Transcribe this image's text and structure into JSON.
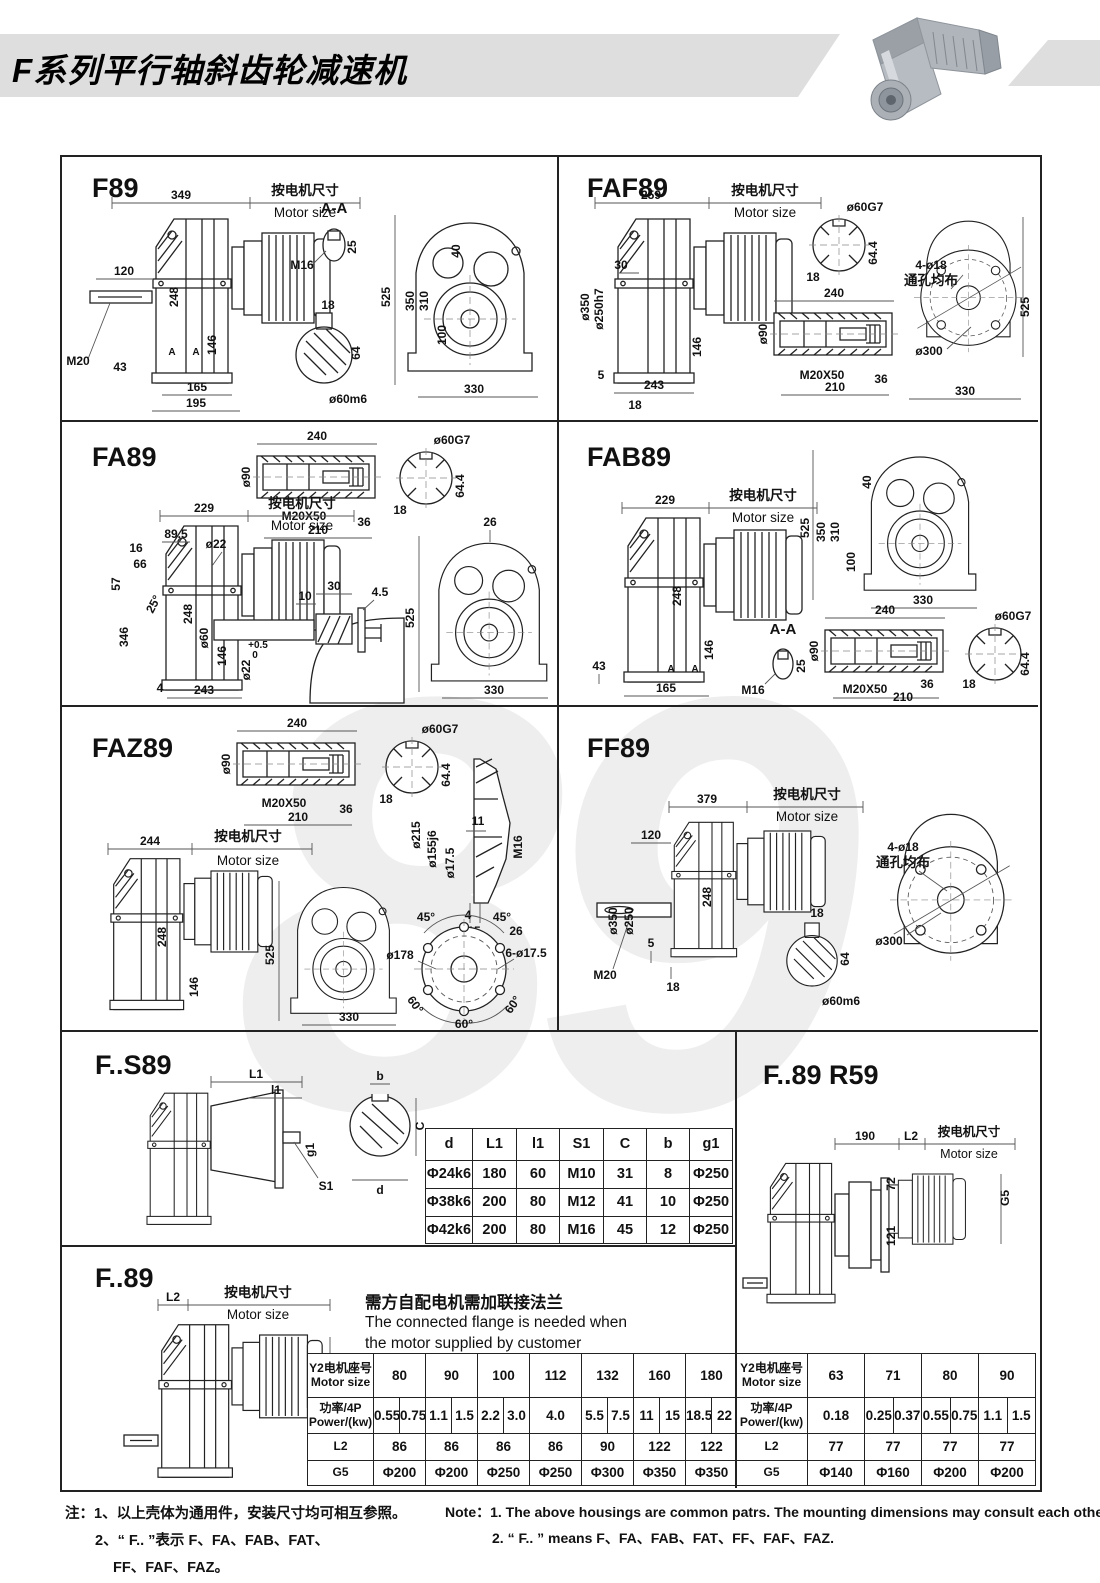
{
  "header": {
    "title": "F系列平行轴斜齿轮减速机"
  },
  "watermark": "89",
  "common": {
    "motor_zh": "按电机尺寸",
    "motor_en": "Motor size"
  },
  "panels": {
    "f89": {
      "title": "F89",
      "aa": "A-A",
      "d349": "349",
      "d120": "120",
      "d248": "248",
      "d146": "146",
      "m20": "M20",
      "d43": "43",
      "d165": "165",
      "d195": "195",
      "m16": "M16",
      "d25": "25",
      "d18": "18",
      "d64": "64",
      "d60m6": "ø60m6",
      "d525": "525",
      "d350": "350",
      "d310": "310",
      "d100": "100",
      "d40": "40",
      "d330": "330",
      "a": "A"
    },
    "faf89": {
      "title": "FAF89",
      "d259": "259",
      "d60g7": "ø60G7",
      "d18": "18",
      "d644": "64.4",
      "d350": "ø350",
      "d250h7": "ø250h7",
      "d30": "30",
      "d146": "146",
      "d5": "5",
      "d243": "243",
      "d18b": "18",
      "d240": "240",
      "d90": "ø90",
      "m20x50": "M20X50",
      "d36": "36",
      "d210": "210",
      "holes": "4-ø18",
      "holes2": "通孔均布",
      "d300": "ø300",
      "d525": "525",
      "d330": "330"
    },
    "fa89": {
      "title": "FA89",
      "d229": "229",
      "d895": "89.5",
      "d16": "16",
      "d66": "66",
      "d57": "57",
      "d22": "ø22",
      "a25": "25°",
      "d346": "346",
      "d248": "248",
      "d146": "146",
      "d4": "4",
      "d243": "243",
      "d240": "240",
      "d90": "ø90",
      "m20x50": "M20X50",
      "d36": "36",
      "d210": "210",
      "d60g7": "ø60G7",
      "d18": "18",
      "d644": "64.4",
      "d26": "26",
      "d30": "30",
      "d10": "10",
      "d45": "4.5",
      "d60": "ø60",
      "d22b": "ø22",
      "tolu": "+0.5",
      "toll": "0",
      "d525": "525",
      "d330": "330"
    },
    "fab89": {
      "title": "FAB89",
      "d229": "229",
      "d248": "248",
      "d146": "146",
      "d43": "43",
      "d165": "165",
      "aa": "A-A",
      "m16": "M16",
      "d25": "25",
      "d525": "525",
      "d350": "350",
      "d310": "310",
      "d100": "100",
      "d40": "40",
      "d330": "330",
      "d240": "240",
      "d90": "ø90",
      "m20x50": "M20X50",
      "d36": "36",
      "d210": "210",
      "d60g7": "ø60G7",
      "d18": "18",
      "d644": "64.4",
      "a": "A"
    },
    "faz89": {
      "title": "FAZ89",
      "d240": "240",
      "d90": "ø90",
      "m20x50": "M20X50",
      "d36": "36",
      "d210": "210",
      "d60g7": "ø60G7",
      "d18": "18",
      "d644": "64.4",
      "d215": "ø215",
      "d155": "ø155j6",
      "d175": "ø17.5",
      "d11": "11",
      "m16": "M16",
      "d4": "4",
      "d15": "15",
      "d26": "26",
      "d244": "244",
      "d248": "248",
      "d146": "146",
      "d525": "525",
      "d330": "330",
      "a45": "45°",
      "d178": "ø178",
      "holes": "6-ø17.5",
      "a60": "60°"
    },
    "ff89": {
      "title": "FF89",
      "d379": "379",
      "d120": "120",
      "d350": "ø350",
      "d250": "ø250",
      "d248": "248",
      "m20": "M20",
      "d5": "5",
      "d18": "18",
      "d64": "64",
      "d60m6": "ø60m6",
      "holes": "4-ø18",
      "holes2": "通孔均布",
      "d300": "ø300"
    },
    "fs89": {
      "title": "F..S89",
      "L1": "L1",
      "l1": "l1",
      "g1": "g1",
      "s1": "S1",
      "b": "b",
      "c": "C",
      "d": "d"
    },
    "fr59": {
      "title": "F..89  R59",
      "d190": "190",
      "L2": "L2",
      "d72": "72",
      "d121": "121",
      "g5": "G5"
    },
    "f89b": {
      "title": "F..89",
      "L2": "L2",
      "g5": "G5",
      "fl_zh": "需方自配电机需加联接法兰",
      "fl_en1": "The connected flange is needed when",
      "fl_en2": "the motor supplied by customer"
    }
  },
  "s89_table": {
    "cols": [
      47,
      44,
      43,
      44,
      43,
      43,
      43
    ],
    "rowh": [
      32,
      28,
      28,
      27
    ],
    "rows": [
      [
        {
          "t": "d",
          "h": 1
        },
        {
          "t": "L1",
          "h": 1
        },
        {
          "t": "l1",
          "h": 1
        },
        {
          "t": "S1",
          "h": 1
        },
        {
          "t": "C",
          "h": 1
        },
        {
          "t": "b",
          "h": 1
        },
        {
          "t": "g1",
          "h": 1
        }
      ],
      [
        "Φ24k6",
        "180",
        "60",
        "M10",
        "31",
        "8",
        "Φ250"
      ],
      [
        "Φ38k6",
        "200",
        "80",
        "M12",
        "41",
        "10",
        "Φ250"
      ],
      [
        "Φ42k6",
        "200",
        "80",
        "M16",
        "45",
        "12",
        "Φ250"
      ]
    ]
  },
  "motor_table_left": {
    "cols": [
      66,
      26,
      26,
      26,
      26,
      26,
      26,
      26,
      26,
      26,
      26,
      26,
      26,
      26,
      26
    ],
    "rowh": [
      44,
      36,
      27,
      25
    ],
    "rows": [
      [
        {
          "t": "Y2电机座号\nMotor size",
          "h": 1
        },
        {
          "t": "80",
          "cs": 2
        },
        {
          "t": "90",
          "cs": 2
        },
        {
          "t": "100",
          "cs": 2
        },
        {
          "t": "112",
          "cs": 2
        },
        {
          "t": "132",
          "cs": 2
        },
        {
          "t": "160",
          "cs": 2
        },
        {
          "t": "180",
          "cs": 2
        }
      ],
      [
        {
          "t": "功率/4P\nPower/(kw)",
          "h": 1
        },
        "0.55",
        "0.75",
        "1.1",
        "1.5",
        "2.2",
        "3.0",
        {
          "t": "4.0",
          "cs": 2
        },
        "5.5",
        "7.5",
        "11",
        "15",
        "18.5",
        "22"
      ],
      [
        {
          "t": "L2",
          "h": 1
        },
        {
          "t": "86",
          "cs": 2
        },
        {
          "t": "86",
          "cs": 2
        },
        {
          "t": "86",
          "cs": 2
        },
        {
          "t": "86",
          "cs": 2
        },
        {
          "t": "90",
          "cs": 2
        },
        {
          "t": "122",
          "cs": 2
        },
        {
          "t": "122",
          "cs": 2
        }
      ],
      [
        {
          "t": "G5",
          "h": 1
        },
        {
          "t": "Φ200",
          "cs": 2
        },
        {
          "t": "Φ200",
          "cs": 2
        },
        {
          "t": "Φ250",
          "cs": 2
        },
        {
          "t": "Φ250",
          "cs": 2
        },
        {
          "t": "Φ300",
          "cs": 2
        },
        {
          "t": "Φ350",
          "cs": 2
        },
        {
          "t": "Φ350",
          "cs": 2
        }
      ]
    ]
  },
  "motor_table_right": {
    "cols": [
      72,
      28.5,
      28.5,
      28.5,
      28.5,
      28.5,
      28.5,
      28.5,
      28.5
    ],
    "rowh": [
      44,
      36,
      27,
      25
    ],
    "rows": [
      [
        {
          "t": "Y2电机座号\nMotor size",
          "h": 1
        },
        {
          "t": "63",
          "cs": 2
        },
        {
          "t": "71",
          "cs": 2
        },
        {
          "t": "80",
          "cs": 2
        },
        {
          "t": "90",
          "cs": 2
        }
      ],
      [
        {
          "t": "功率/4P\nPower/(kw)",
          "h": 1
        },
        {
          "t": "0.18",
          "cs": 2
        },
        "0.25",
        "0.37",
        "0.55",
        "0.75",
        "1.1",
        "1.5"
      ],
      [
        {
          "t": "L2",
          "h": 1
        },
        {
          "t": "77",
          "cs": 2
        },
        {
          "t": "77",
          "cs": 2
        },
        {
          "t": "77",
          "cs": 2
        },
        {
          "t": "77",
          "cs": 2
        }
      ],
      [
        {
          "t": "G5",
          "h": 1
        },
        {
          "t": "Φ140",
          "cs": 2
        },
        {
          "t": "Φ160",
          "cs": 2
        },
        {
          "t": "Φ200",
          "cs": 2
        },
        {
          "t": "Φ200",
          "cs": 2
        }
      ]
    ]
  },
  "notes": {
    "zh1": "注：1、以上壳体为通用件，安装尺寸均可相互参照。",
    "zh2": "2、“ F.. ”表示 F、FA、FAB、FAT、",
    "zh3": "FF、FAF、FAZ。",
    "en1": "Note：1.  The above housings are common patrs. The mounting dimensions may consult each other.",
    "en2": "2. “ F.. ”  means F、FA、FAB、FAT、FF、FAF、FAZ."
  }
}
